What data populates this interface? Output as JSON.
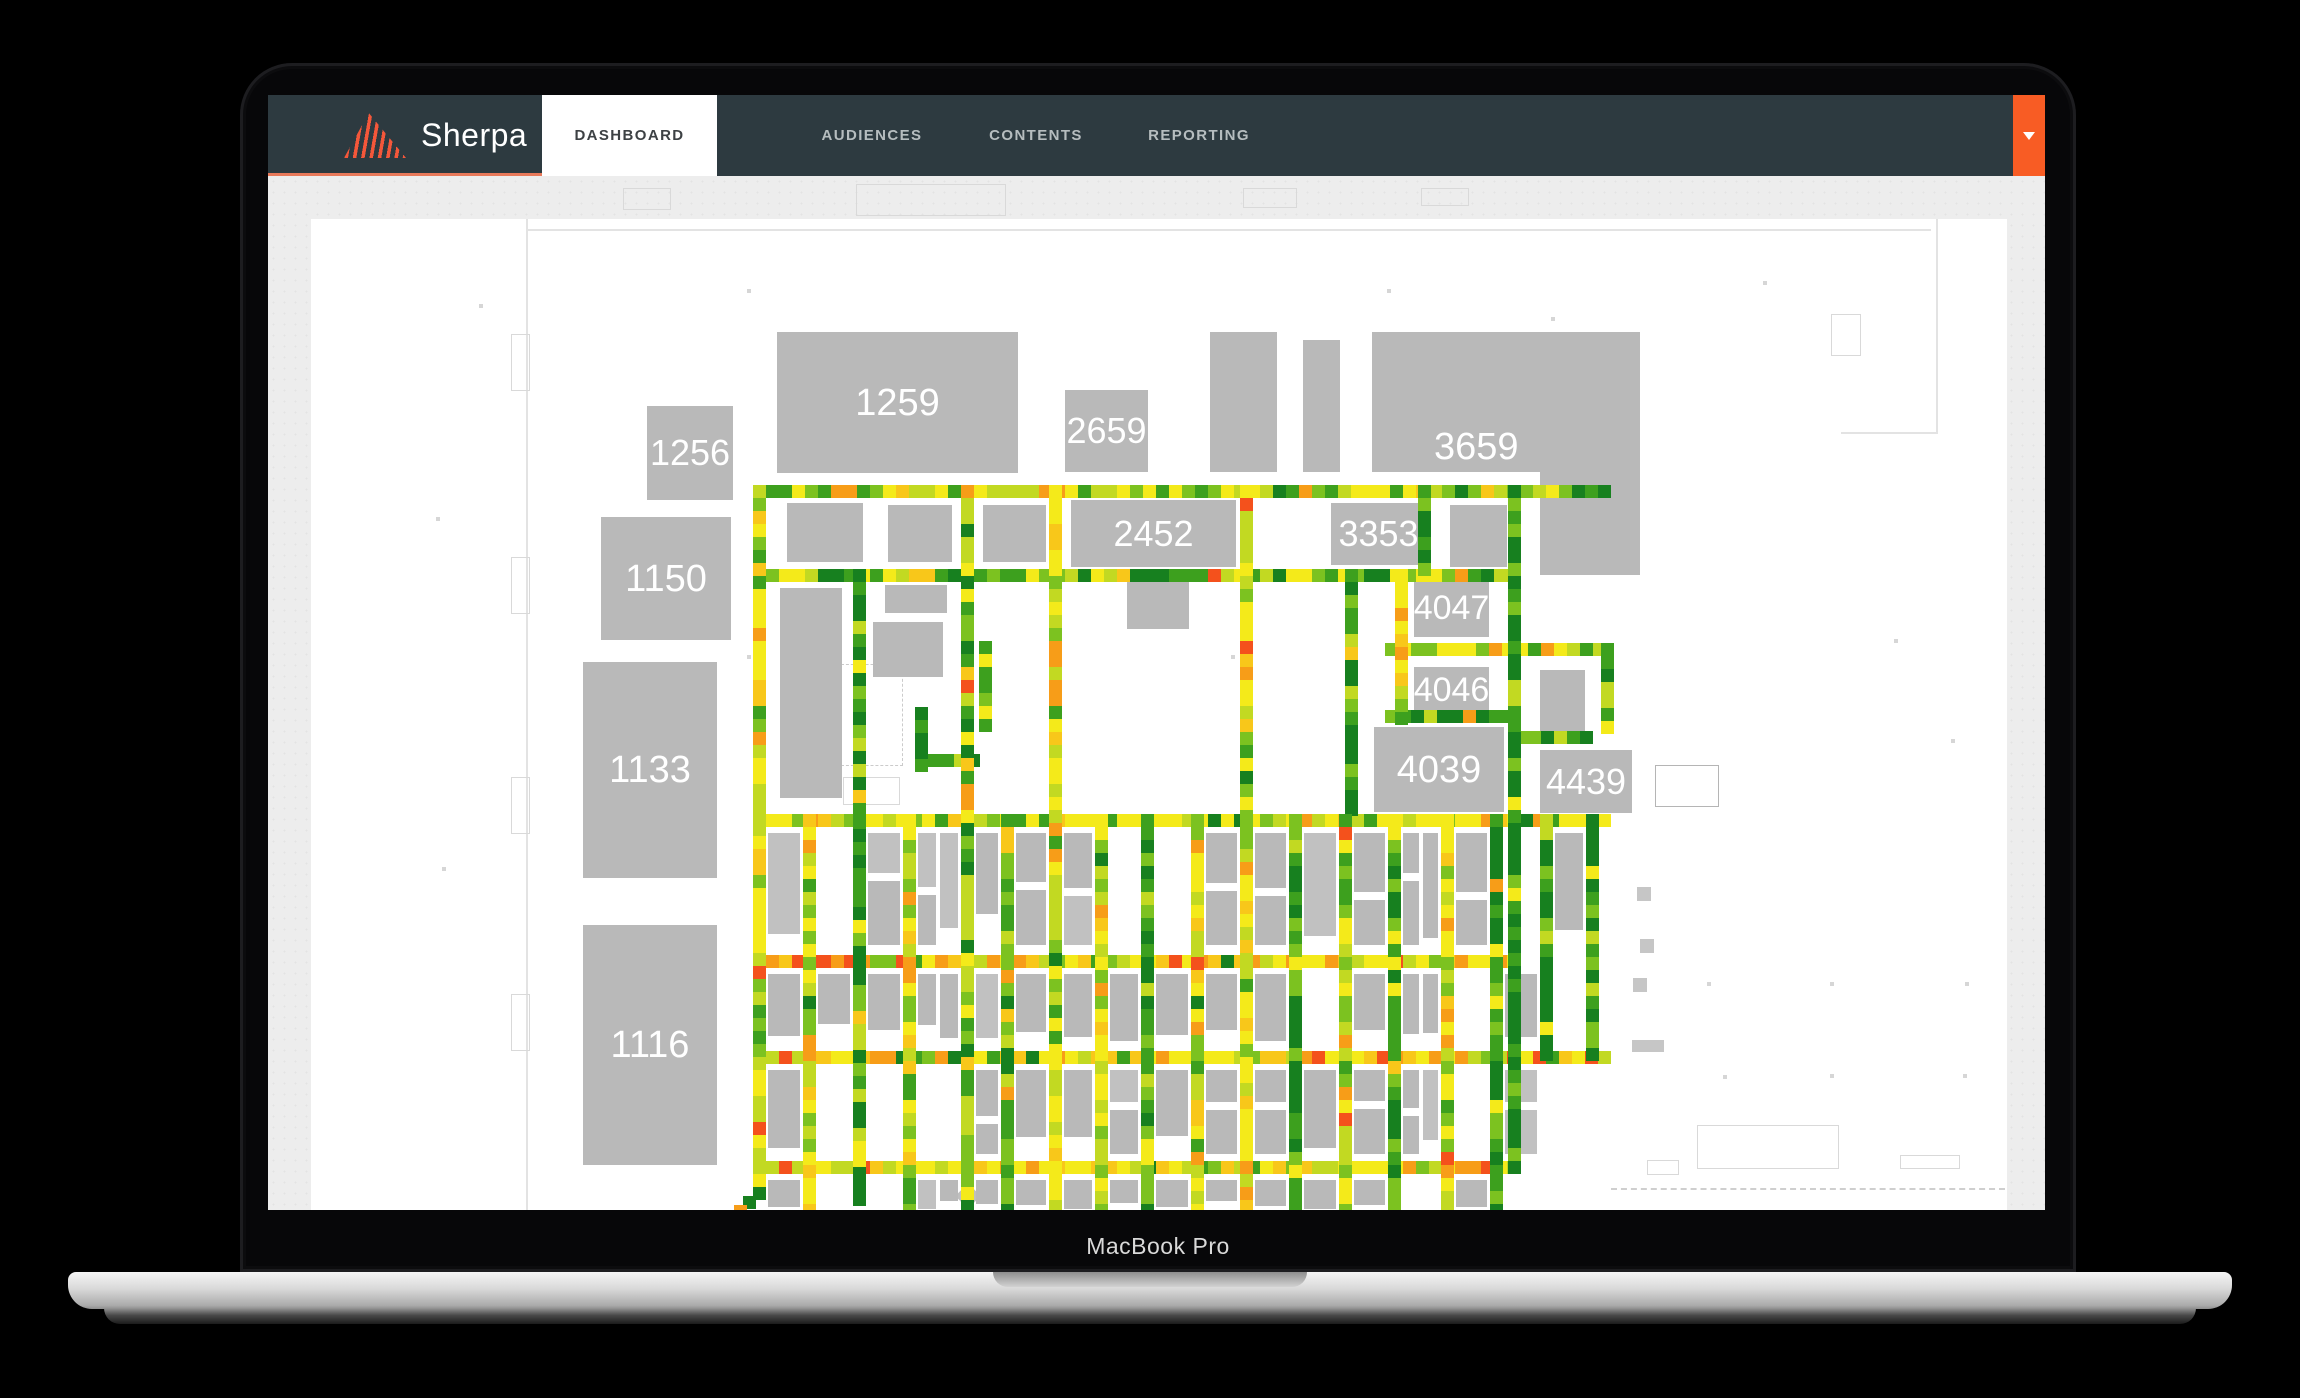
{
  "device": {
    "label": "MacBook Pro"
  },
  "navbar": {
    "brand": "Sherpa",
    "tabs": [
      {
        "label": "DASHBOARD",
        "active": true
      },
      {
        "label": "AUDIENCES",
        "active": false
      },
      {
        "label": "CONTENTS",
        "active": false
      },
      {
        "label": "REPORTING",
        "active": false
      }
    ]
  },
  "colors": {
    "accent_orange": "#f85c24",
    "nav_bg": "#2d3a40",
    "nav_underline": "#e8795a",
    "nav_text_inactive": "#b6bdbf",
    "nav_text_active": "#3d4144",
    "content_bg": "#ededed",
    "panel_bg": "#ffffff",
    "booth_gray": "#b9b9b9",
    "booth_label": "#ffffff",
    "heat": {
      "dark": "#17801f",
      "green": "#3da01e",
      "lgreen": "#7cc220",
      "ygreen": "#c2d922",
      "yellow": "#f4ea1a",
      "yorange": "#f8c71a",
      "orange": "#f79d18",
      "red": "#f4511c"
    }
  },
  "floorplan": {
    "seed": 42,
    "tile": 13,
    "biases": {
      "mixed": {
        "dark": 2,
        "green": 2.5,
        "lgreen": 2.5,
        "ygreen": 2,
        "yellow": 2.5,
        "yorange": 0.7,
        "orange": 0.6,
        "red": 0.15
      },
      "green": {
        "dark": 3.5,
        "green": 3.5,
        "lgreen": 2.5,
        "ygreen": 1,
        "yellow": 0.8,
        "yorange": 0.2,
        "orange": 0.15,
        "red": 0
      },
      "yellow": {
        "dark": 0.4,
        "green": 0.9,
        "lgreen": 2,
        "ygreen": 2.8,
        "yellow": 4.5,
        "yorange": 1.2,
        "orange": 1,
        "red": 0.25
      },
      "hot": {
        "dark": 0.2,
        "green": 0.6,
        "lgreen": 1.2,
        "ygreen": 2,
        "yellow": 3.5,
        "yorange": 1.5,
        "orange": 2.2,
        "red": 0.8
      },
      "dark": {
        "dark": 5,
        "green": 3,
        "lgreen": 1.2,
        "ygreen": 0.4,
        "yellow": 0.3,
        "yorange": 0,
        "orange": 0,
        "red": 0
      }
    },
    "booths": [
      {
        "label": "1256",
        "fs": 36,
        "x": 336,
        "y": 187,
        "w": 86,
        "h": 94
      },
      {
        "label": "1259",
        "fs": 38,
        "x": 466,
        "y": 113,
        "w": 241,
        "h": 141
      },
      {
        "label": "2659",
        "fs": 36,
        "x": 754,
        "y": 171,
        "w": 83,
        "h": 82
      },
      {
        "x": 899,
        "y": 113,
        "w": 67,
        "h": 140
      },
      {
        "x": 992,
        "y": 121,
        "w": 37,
        "h": 132
      },
      {
        "label": "3659",
        "fs": 38,
        "x": 1061,
        "y": 113,
        "w": 268,
        "h": 140,
        "lx": 62,
        "ly": 96
      },
      {
        "x": 1229,
        "y": 253,
        "w": 100,
        "h": 103
      },
      {
        "label": "2452",
        "fs": 36,
        "x": 760,
        "y": 281,
        "w": 165,
        "h": 67
      },
      {
        "label": "3353",
        "fs": 36,
        "x": 1020,
        "y": 284,
        "w": 95,
        "h": 62
      },
      {
        "x": 1139,
        "y": 286,
        "w": 57,
        "h": 62
      },
      {
        "label": "4047",
        "fs": 34,
        "x": 1103,
        "y": 359,
        "w": 75,
        "h": 59
      },
      {
        "label": "4046",
        "fs": 34,
        "x": 1103,
        "y": 448,
        "w": 75,
        "h": 46
      },
      {
        "x": 1229,
        "y": 451,
        "w": 45,
        "h": 62
      },
      {
        "label": "4039",
        "fs": 38,
        "x": 1063,
        "y": 508,
        "w": 130,
        "h": 85
      },
      {
        "label": "4439",
        "fs": 36,
        "x": 1229,
        "y": 531,
        "w": 92,
        "h": 63
      },
      {
        "label": "1150",
        "fs": 38,
        "x": 290,
        "y": 298,
        "w": 130,
        "h": 123
      },
      {
        "label": "1133",
        "fs": 38,
        "x": 272,
        "y": 443,
        "w": 134,
        "h": 216
      },
      {
        "label": "1116",
        "fs": 38,
        "x": 272,
        "y": 706,
        "w": 134,
        "h": 240
      },
      {
        "x": 476,
        "y": 284,
        "w": 76,
        "h": 59
      },
      {
        "x": 577,
        "y": 286,
        "w": 64,
        "h": 57
      },
      {
        "x": 672,
        "y": 286,
        "w": 63,
        "h": 57
      },
      {
        "x": 469,
        "y": 369,
        "w": 62,
        "h": 210
      },
      {
        "x": 574,
        "y": 366,
        "w": 62,
        "h": 28
      },
      {
        "x": 562,
        "y": 403,
        "w": 70,
        "h": 55
      },
      {
        "x": 816,
        "y": 363,
        "w": 62,
        "h": 47
      }
    ],
    "aisles": [
      {
        "x1": 448,
        "y1": 272,
        "x2": 1303,
        "y2": 272,
        "b": "mixed"
      },
      {
        "x1": 448,
        "y1": 356,
        "x2": 1210,
        "y2": 356,
        "b": "mixed"
      },
      {
        "x1": 1080,
        "y1": 430,
        "x2": 1296,
        "y2": 430,
        "b": "yellow"
      },
      {
        "x1": 1210,
        "y1": 518,
        "x2": 1283,
        "y2": 518,
        "b": "green"
      },
      {
        "x1": 1080,
        "y1": 497,
        "x2": 1203,
        "y2": 497,
        "b": "green"
      },
      {
        "x1": 448,
        "y1": 601,
        "x2": 1303,
        "y2": 601,
        "b": "yellow"
      },
      {
        "x1": 448,
        "y1": 742,
        "x2": 1210,
        "y2": 742,
        "b": "hot"
      },
      {
        "x1": 448,
        "y1": 838,
        "x2": 1296,
        "y2": 838,
        "b": "hot"
      },
      {
        "x1": 448,
        "y1": 948,
        "x2": 1210,
        "y2": 948,
        "b": "hot"
      },
      {
        "x1": 610,
        "y1": 541,
        "x2": 670,
        "y2": 541,
        "b": "dark"
      },
      {
        "x1": 448,
        "y1": 272,
        "x2": 448,
        "y2": 972,
        "b": "yellow"
      },
      {
        "x1": 548,
        "y1": 356,
        "x2": 548,
        "y2": 991,
        "b": "green"
      },
      {
        "x1": 656,
        "y1": 272,
        "x2": 656,
        "y2": 991,
        "b": "mixed"
      },
      {
        "x1": 744,
        "y1": 272,
        "x2": 744,
        "y2": 991,
        "b": "yellow"
      },
      {
        "x1": 935,
        "y1": 272,
        "x2": 935,
        "y2": 991,
        "b": "yellow"
      },
      {
        "x1": 1203,
        "y1": 272,
        "x2": 1203,
        "y2": 960,
        "b": "dark"
      },
      {
        "x1": 1113,
        "y1": 272,
        "x2": 1113,
        "y2": 356,
        "b": "green"
      },
      {
        "x1": 1040,
        "y1": 356,
        "x2": 1040,
        "y2": 601,
        "b": "green"
      },
      {
        "x1": 1090,
        "y1": 356,
        "x2": 1090,
        "y2": 506,
        "b": "yellow"
      },
      {
        "x1": 1296,
        "y1": 430,
        "x2": 1296,
        "y2": 518,
        "b": "dark"
      },
      {
        "x1": 610,
        "y1": 494,
        "x2": 610,
        "y2": 548,
        "b": "dark"
      },
      {
        "x1": 674,
        "y1": 428,
        "x2": 674,
        "y2": 514,
        "b": "dark"
      },
      {
        "x1": 498,
        "y1": 601,
        "x2": 498,
        "y2": 991,
        "b": "yellow"
      },
      {
        "x1": 598,
        "y1": 601,
        "x2": 598,
        "y2": 991,
        "b": "yellow"
      },
      {
        "x1": 696,
        "y1": 601,
        "x2": 696,
        "y2": 991,
        "b": "mixed"
      },
      {
        "x1": 790,
        "y1": 601,
        "x2": 790,
        "y2": 991,
        "b": "yellow"
      },
      {
        "x1": 836,
        "y1": 601,
        "x2": 836,
        "y2": 991,
        "b": "green"
      },
      {
        "x1": 886,
        "y1": 601,
        "x2": 886,
        "y2": 991,
        "b": "yellow"
      },
      {
        "x1": 984,
        "y1": 601,
        "x2": 984,
        "y2": 991,
        "b": "green"
      },
      {
        "x1": 1034,
        "y1": 601,
        "x2": 1034,
        "y2": 991,
        "b": "yellow"
      },
      {
        "x1": 1083,
        "y1": 601,
        "x2": 1083,
        "y2": 991,
        "b": "green"
      },
      {
        "x1": 1136,
        "y1": 601,
        "x2": 1136,
        "y2": 991,
        "b": "yellow"
      },
      {
        "x1": 1185,
        "y1": 601,
        "x2": 1185,
        "y2": 991,
        "b": "green"
      },
      {
        "x1": 1235,
        "y1": 601,
        "x2": 1235,
        "y2": 838,
        "b": "dark"
      },
      {
        "x1": 1281,
        "y1": 601,
        "x2": 1281,
        "y2": 841,
        "b": "green"
      }
    ],
    "diagonal": {
      "x": 448,
      "y": 974,
      "n": 4,
      "b": "green"
    },
    "grid": {
      "x_aisles": [
        448,
        498,
        548,
        598,
        656,
        696,
        744,
        790,
        836,
        886,
        935,
        984,
        1034,
        1083,
        1136,
        1185,
        1235,
        1281
      ],
      "rows": [
        {
          "y": 614,
          "h": 112
        },
        {
          "y": 755,
          "h": 70
        },
        {
          "y": 851,
          "h": 84
        },
        {
          "y": 961,
          "h": 30
        }
      ],
      "right_limit_x": 1210,
      "right_limit_y": 845
    },
    "outlines": [
      {
        "x": 215,
        "y": 10,
        "w": 1405,
        "h": 2,
        "t": "wall"
      },
      {
        "x": 215,
        "y": 0,
        "w": 2,
        "h": 991,
        "t": "wall"
      },
      {
        "x": 1625,
        "y": 0,
        "w": 2,
        "h": 215,
        "t": "wall"
      },
      {
        "x": 1530,
        "y": 213,
        "w": 97,
        "h": 2,
        "t": "wall"
      },
      {
        "x": 200,
        "y": 115,
        "w": 17,
        "h": 55,
        "t": "box"
      },
      {
        "x": 200,
        "y": 338,
        "w": 17,
        "h": 55,
        "t": "box"
      },
      {
        "x": 200,
        "y": 558,
        "w": 17,
        "h": 55,
        "t": "box"
      },
      {
        "x": 200,
        "y": 775,
        "w": 17,
        "h": 55,
        "t": "box"
      },
      {
        "x": 1520,
        "y": 95,
        "w": 28,
        "h": 40,
        "t": "box"
      },
      {
        "x": 530,
        "y": 445,
        "w": 60,
        "h": 100,
        "t": "dash"
      },
      {
        "x": 532,
        "y": 558,
        "w": 55,
        "h": 26,
        "t": "box"
      },
      {
        "x": 1386,
        "y": 906,
        "w": 140,
        "h": 42,
        "t": "box"
      },
      {
        "x": 1589,
        "y": 936,
        "w": 58,
        "h": 12,
        "t": "box"
      },
      {
        "x": 1336,
        "y": 941,
        "w": 30,
        "h": 13,
        "t": "box"
      },
      {
        "x": 1300,
        "y": 969,
        "w": 394,
        "h": 0,
        "t": "dashline"
      },
      {
        "x": 1344,
        "y": 546,
        "w": 62,
        "h": 40,
        "t": "white"
      },
      {
        "x": 634,
        "y": 118,
        "w": 2,
        "h": 130,
        "t": "lite"
      },
      {
        "x": 1322,
        "y": 759,
        "w": 14,
        "h": 14,
        "t": "lite"
      },
      {
        "x": 1321,
        "y": 821,
        "w": 32,
        "h": 12,
        "t": "lite"
      },
      {
        "x": 1326,
        "y": 668,
        "w": 14,
        "h": 14,
        "t": "lite"
      },
      {
        "x": 1329,
        "y": 720,
        "w": 14,
        "h": 14,
        "t": "lite"
      },
      {
        "x": 648,
        "y": 968,
        "w": 18,
        "h": 18,
        "t": "diamond"
      }
    ],
    "dots": [
      [
        1396,
        763
      ],
      [
        1519,
        763
      ],
      [
        1654,
        763
      ],
      [
        1412,
        856
      ],
      [
        1519,
        855
      ],
      [
        1652,
        855
      ],
      [
        1240,
        98
      ],
      [
        1452,
        62
      ],
      [
        1583,
        420
      ],
      [
        1640,
        520
      ],
      [
        125,
        298
      ],
      [
        131,
        648
      ],
      [
        168,
        85
      ],
      [
        920,
        232
      ],
      [
        1310,
        232
      ],
      [
        436,
        70
      ],
      [
        1076,
        70
      ],
      [
        436,
        436
      ],
      [
        920,
        436
      ]
    ],
    "vents": [
      {
        "x": 355,
        "y": 12,
        "w": 46,
        "h": 20
      },
      {
        "x": 588,
        "y": 8,
        "w": 148,
        "h": 30
      },
      {
        "x": 975,
        "y": 12,
        "w": 52,
        "h": 18
      },
      {
        "x": 1153,
        "y": 12,
        "w": 46,
        "h": 16
      }
    ]
  }
}
